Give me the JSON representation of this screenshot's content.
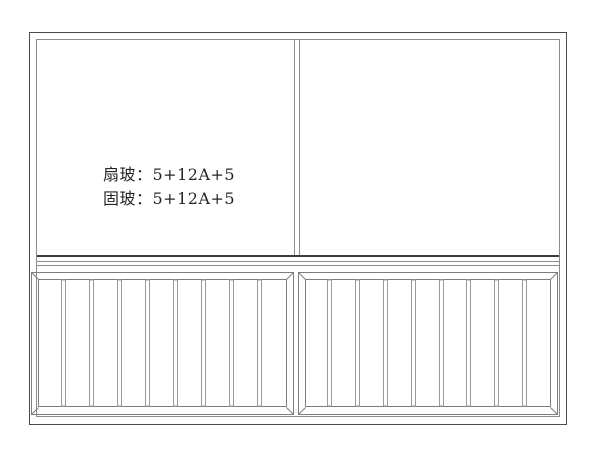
{
  "drawing": {
    "background_color": "#ffffff",
    "colors": {
      "frame_dark": "#4a4a4a",
      "line_medium": "#8b8b8b",
      "transom_dark": "#3d3d3d",
      "panel_line": "#7d7d7d",
      "bar_line": "#9a9a9a",
      "text": "#262626"
    },
    "annotation": {
      "line1": "扇玻：5+12A+5",
      "line2": "固玻：5+12A+5"
    },
    "structure": {
      "upper_glass_panes": 2,
      "lower_grille_panels": 2,
      "bars_per_grille_panel": 8
    }
  }
}
